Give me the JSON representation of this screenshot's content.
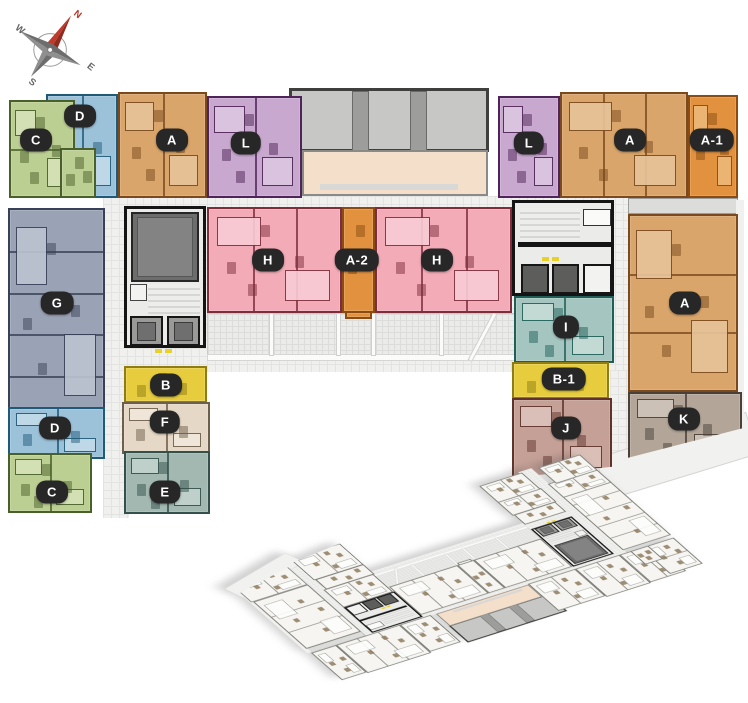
{
  "compass": {
    "directions": [
      {
        "label": "N",
        "color": "#b63425"
      },
      {
        "label": "E",
        "color": "#666666"
      },
      {
        "label": "S",
        "color": "#666666"
      },
      {
        "label": "W",
        "color": "#666666"
      }
    ]
  },
  "floorplan": {
    "colors": {
      "A": {
        "fill": "#d9a56a",
        "wall": "#7a4a1e",
        "room": "#e8c49a"
      },
      "A1": {
        "fill": "#e2923f",
        "wall": "#8a4c12",
        "room": "#eeb878"
      },
      "A2": {
        "fill": "#e2923f",
        "wall": "#8a4c12",
        "room": "#eeb878"
      },
      "B": {
        "fill": "#e7cd3d",
        "wall": "#8f7d14",
        "room": "#f0e08a"
      },
      "B1": {
        "fill": "#e7cd3d",
        "wall": "#8f7d14",
        "room": "#f0e08a"
      },
      "C": {
        "fill": "#bccf93",
        "wall": "#49602b",
        "room": "#d6e2b8"
      },
      "D": {
        "fill": "#9cc2da",
        "wall": "#1f5a78",
        "room": "#c2dbea"
      },
      "E": {
        "fill": "#a3b8b1",
        "wall": "#33504b",
        "room": "#c3d2cc"
      },
      "F": {
        "fill": "#e6d8c6",
        "wall": "#6e5f4c",
        "room": "#f0e7da"
      },
      "G": {
        "fill": "#9aa3b5",
        "wall": "#394158",
        "room": "#bcc3d0"
      },
      "H": {
        "fill": "#f2abb7",
        "wall": "#7d2e3d",
        "room": "#f8ccd4"
      },
      "I": {
        "fill": "#a5c6c0",
        "wall": "#1f5f57",
        "room": "#c6dcd7"
      },
      "J": {
        "fill": "#c5a096",
        "wall": "#5f332c",
        "room": "#dcc3bb"
      },
      "K": {
        "fill": "#b3a698",
        "wall": "#4a4038",
        "room": "#cfc5ba"
      },
      "L": {
        "fill": "#c8a8cf",
        "wall": "#4f2458",
        "room": "#dcc6e1"
      }
    },
    "zones": [
      {
        "name": "courtyard-grid",
        "x": 103,
        "y": 196,
        "w": 527,
        "h": 176,
        "grid": 1
      },
      {
        "name": "courtyard-grid-left",
        "x": 103,
        "y": 370,
        "w": 26,
        "h": 148,
        "grid": 1
      },
      {
        "name": "courtyard-grid-right",
        "x": 610,
        "y": 370,
        "w": 20,
        "h": 96,
        "grid": 1
      },
      {
        "name": "balcony-strip-diagonal",
        "x": 598,
        "y": 434,
        "w": 158,
        "h": 44,
        "bg": "#f1f1ef",
        "bd": "1px solid #d4d4d2",
        "rot": -17
      },
      {
        "name": "terrace-top",
        "x": 289,
        "y": 88,
        "w": 200,
        "h": 64,
        "bg": "#c7c7c5",
        "bd": "3px solid #3f3f3d"
      },
      {
        "name": "terrace-pillar",
        "x": 352,
        "y": 91,
        "w": 17,
        "h": 60,
        "bg": "#9d9d9b",
        "bd": "1px solid #6a6a68"
      },
      {
        "name": "terrace-pillar",
        "x": 410,
        "y": 91,
        "w": 17,
        "h": 60,
        "bg": "#9d9d9b",
        "bd": "1px solid #6a6a68"
      },
      {
        "name": "amenity-room",
        "x": 302,
        "y": 150,
        "w": 186,
        "h": 46,
        "bg": "#f4dfca",
        "bd": "2px solid #8a8a88"
      },
      {
        "name": "amenity-table",
        "x": 320,
        "y": 184,
        "w": 138,
        "h": 6,
        "bg": "#d8d8d6"
      },
      {
        "name": "terrace-mid",
        "x": 207,
        "y": 313,
        "w": 308,
        "h": 47,
        "grid": 2,
        "bd": "1px solid #c9c9c7"
      },
      {
        "name": "terrace-edge",
        "x": 207,
        "y": 354,
        "w": 308,
        "h": 7,
        "bg": "#fbfbfa",
        "bd": "1px solid #d6d6d4"
      },
      {
        "name": "terrace-divider",
        "x": 269,
        "y": 313,
        "w": 5,
        "h": 43,
        "bg": "#fbfbfa",
        "bd": "1px solid #d0d0ce"
      },
      {
        "name": "terrace-divider",
        "x": 336,
        "y": 313,
        "w": 5,
        "h": 43,
        "bg": "#fbfbfa",
        "bd": "1px solid #d0d0ce"
      },
      {
        "name": "terrace-divider",
        "x": 371,
        "y": 313,
        "w": 5,
        "h": 43,
        "bg": "#fbfbfa",
        "bd": "1px solid #d0d0ce"
      },
      {
        "name": "terrace-divider",
        "x": 439,
        "y": 313,
        "w": 5,
        "h": 43,
        "bg": "#fbfbfa",
        "bd": "1px solid #d0d0ce"
      },
      {
        "name": "terrace-divider-diagonal",
        "x": 480,
        "y": 310,
        "w": 5,
        "h": 54,
        "bg": "#fbfbfa",
        "bd": "1px solid #d0d0ce",
        "rot": 28
      },
      {
        "name": "core-left",
        "x": 124,
        "y": 206,
        "w": 82,
        "h": 142,
        "bg": "#ebebe9",
        "bd": "3px solid #141414"
      },
      {
        "name": "core-left-shaft",
        "x": 131,
        "y": 212,
        "w": 68,
        "h": 70,
        "bg": "#6d6d6d",
        "bd": "2px solid #262626"
      },
      {
        "name": "core-left-shaft-inner",
        "x": 137,
        "y": 217,
        "w": 56,
        "h": 60,
        "bg": "#838383",
        "bd": "1px solid #565656"
      },
      {
        "name": "core-left-stairs",
        "x": 148,
        "y": 284,
        "w": 52,
        "h": 30,
        "stairs": 1
      },
      {
        "name": "core-left-closet",
        "x": 130,
        "y": 284,
        "w": 17,
        "h": 17,
        "bg": "#f2f2f0",
        "bd": "1px solid #444444"
      },
      {
        "name": "lift",
        "x": 130,
        "y": 316,
        "w": 33,
        "h": 30,
        "bg": "#9a9a98",
        "bd": "2px solid #161616"
      },
      {
        "name": "lift-car",
        "x": 137,
        "y": 322,
        "w": 19,
        "h": 19,
        "bg": "#6f6f6f",
        "bd": "1px solid #3a3a3a"
      },
      {
        "name": "lift",
        "x": 167,
        "y": 316,
        "w": 33,
        "h": 30,
        "bg": "#9a9a98",
        "bd": "2px solid #161616"
      },
      {
        "name": "lift-car",
        "x": 174,
        "y": 322,
        "w": 19,
        "h": 19,
        "bg": "#6f6f6f",
        "bd": "1px solid #3a3a3a"
      },
      {
        "name": "marker-dash",
        "x": 155,
        "y": 349,
        "w": 7,
        "h": 4,
        "bg": "#e8d22a"
      },
      {
        "name": "marker-dash",
        "x": 165,
        "y": 349,
        "w": 7,
        "h": 4,
        "bg": "#e8d22a"
      },
      {
        "name": "core-right",
        "x": 512,
        "y": 200,
        "w": 102,
        "h": 96,
        "bg": "#ebebe9",
        "bd": "3px solid #141414"
      },
      {
        "name": "core-right-stairs",
        "x": 520,
        "y": 208,
        "w": 60,
        "h": 32,
        "stairs": 1
      },
      {
        "name": "core-right-closet",
        "x": 583,
        "y": 209,
        "w": 28,
        "h": 17,
        "bg": "#fafaf8",
        "bd": "1px solid #333333"
      },
      {
        "name": "core-right-wall",
        "x": 518,
        "y": 242,
        "w": 94,
        "h": 5,
        "bg": "#141414"
      },
      {
        "name": "marker-dash",
        "x": 542,
        "y": 257,
        "w": 7,
        "h": 4,
        "bg": "#e8d22a"
      },
      {
        "name": "marker-dash",
        "x": 552,
        "y": 257,
        "w": 7,
        "h": 4,
        "bg": "#e8d22a"
      },
      {
        "name": "lift-dark",
        "x": 521,
        "y": 264,
        "w": 28,
        "h": 30,
        "bg": "#5d5d5b",
        "bd": "2px solid #161616"
      },
      {
        "name": "lift-dark",
        "x": 552,
        "y": 264,
        "w": 27,
        "h": 30,
        "bg": "#5d5d5b",
        "bd": "2px solid #161616"
      },
      {
        "name": "core-right-cell",
        "x": 583,
        "y": 264,
        "w": 29,
        "h": 30,
        "bg": "#f2f2f0",
        "bd": "2px solid #161616"
      },
      {
        "name": "balcony-strip",
        "x": 628,
        "y": 198,
        "w": 110,
        "h": 16,
        "bg": "#dcdcda",
        "bd": "1px solid #9a9a96"
      },
      {
        "name": "outer-strip",
        "x": 736,
        "y": 200,
        "w": 8,
        "h": 230,
        "bg": "#f0f0ee"
      }
    ],
    "units": [
      {
        "t": "D",
        "x": 46,
        "y": 94,
        "w": 72,
        "h": 104,
        "div": "v",
        "nd": 1
      },
      {
        "t": "C",
        "x": 9,
        "y": 100,
        "w": 66,
        "h": 98,
        "div": "h",
        "nd": 1
      },
      {
        "t": "C",
        "x": 60,
        "y": 148,
        "w": 36,
        "h": 50
      },
      {
        "t": "A",
        "x": 118,
        "y": 92,
        "w": 89,
        "h": 106,
        "div": "v",
        "nd": 1
      },
      {
        "t": "L",
        "x": 207,
        "y": 96,
        "w": 95,
        "h": 102,
        "div": "v",
        "nd": 1
      },
      {
        "t": "L",
        "x": 498,
        "y": 96,
        "w": 62,
        "h": 102
      },
      {
        "t": "A",
        "x": 560,
        "y": 92,
        "w": 128,
        "h": 106,
        "div": "v",
        "nd": 2
      },
      {
        "t": "A1",
        "x": 688,
        "y": 95,
        "w": 50,
        "h": 103
      },
      {
        "t": "G",
        "x": 8,
        "y": 208,
        "w": 97,
        "h": 211,
        "div": "h",
        "nd": 4
      },
      {
        "t": "D",
        "x": 8,
        "y": 407,
        "w": 97,
        "h": 52,
        "div": "v",
        "nd": 1
      },
      {
        "t": "C",
        "x": 8,
        "y": 453,
        "w": 84,
        "h": 60,
        "div": "v",
        "nd": 1
      },
      {
        "t": "H",
        "x": 207,
        "y": 207,
        "w": 135,
        "h": 106,
        "div": "v",
        "nd": 2
      },
      {
        "t": "A2",
        "x": 342,
        "y": 207,
        "w": 33,
        "h": 106
      },
      {
        "t": "A2",
        "x": 345,
        "y": 311,
        "w": 27,
        "h": 8
      },
      {
        "t": "H",
        "x": 375,
        "y": 207,
        "w": 137,
        "h": 106,
        "div": "v",
        "nd": 2
      },
      {
        "t": "B",
        "x": 124,
        "y": 366,
        "w": 83,
        "h": 37
      },
      {
        "t": "F",
        "x": 122,
        "y": 402,
        "w": 88,
        "h": 52,
        "div": "v",
        "nd": 1
      },
      {
        "t": "E",
        "x": 124,
        "y": 451,
        "w": 86,
        "h": 63,
        "div": "v",
        "nd": 1
      },
      {
        "t": "I",
        "x": 514,
        "y": 296,
        "w": 100,
        "h": 67,
        "div": "v",
        "nd": 1
      },
      {
        "t": "B1",
        "x": 512,
        "y": 362,
        "w": 97,
        "h": 37
      },
      {
        "t": "J",
        "x": 512,
        "y": 398,
        "w": 100,
        "h": 80,
        "div": "v",
        "nd": 1,
        "clip": "polygon(0 0,100% 0,100% 86%,0 100%)"
      },
      {
        "t": "A",
        "x": 628,
        "y": 214,
        "w": 110,
        "h": 178,
        "div": "h",
        "nd": 2
      },
      {
        "t": "K",
        "x": 628,
        "y": 392,
        "w": 114,
        "h": 70,
        "div": "v",
        "nd": 1,
        "clip": "polygon(0 0,100% 0,100% 52%,0 94%)"
      }
    ],
    "badges": [
      {
        "text": "C",
        "cx": 36,
        "cy": 140
      },
      {
        "text": "D",
        "cx": 80,
        "cy": 116
      },
      {
        "text": "A",
        "cx": 172,
        "cy": 140
      },
      {
        "text": "L",
        "cx": 246,
        "cy": 143
      },
      {
        "text": "L",
        "cx": 529,
        "cy": 143
      },
      {
        "text": "A",
        "cx": 630,
        "cy": 140
      },
      {
        "text": "A-1",
        "cx": 712,
        "cy": 140
      },
      {
        "text": "G",
        "cx": 57,
        "cy": 303
      },
      {
        "text": "H",
        "cx": 268,
        "cy": 260
      },
      {
        "text": "A-2",
        "cx": 357,
        "cy": 260
      },
      {
        "text": "H",
        "cx": 437,
        "cy": 260
      },
      {
        "text": "A",
        "cx": 685,
        "cy": 303
      },
      {
        "text": "I",
        "cx": 566,
        "cy": 327
      },
      {
        "text": "B",
        "cx": 166,
        "cy": 385
      },
      {
        "text": "B-1",
        "cx": 564,
        "cy": 379
      },
      {
        "text": "D",
        "cx": 55,
        "cy": 428
      },
      {
        "text": "F",
        "cx": 165,
        "cy": 422
      },
      {
        "text": "J",
        "cx": 566,
        "cy": 428
      },
      {
        "text": "K",
        "cx": 684,
        "cy": 419
      },
      {
        "text": "C",
        "cx": 52,
        "cy": 492
      },
      {
        "text": "E",
        "cx": 165,
        "cy": 492
      }
    ]
  }
}
